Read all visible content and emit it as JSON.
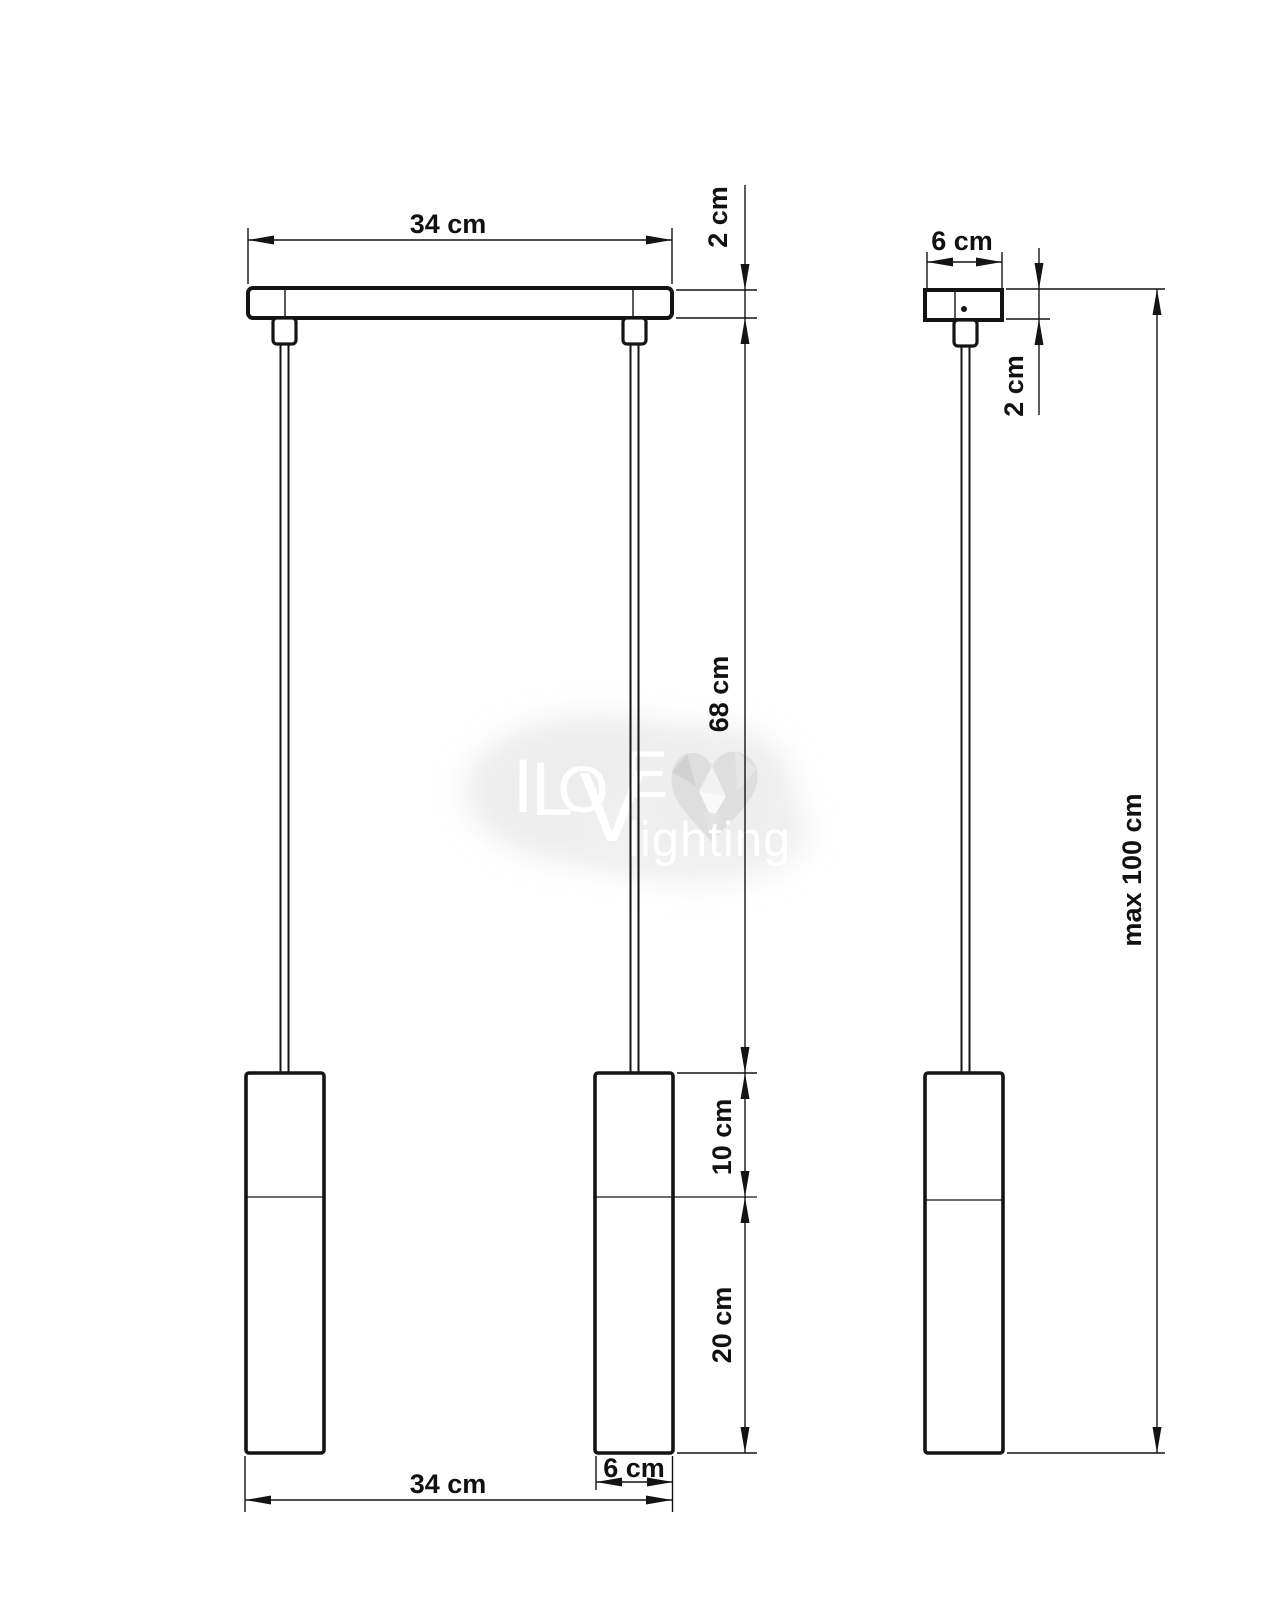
{
  "page": {
    "title": "Pendant lamp dimension drawing",
    "background_color": "#ffffff",
    "line_color": "#141414",
    "watermark_color": "#e9e9e9"
  },
  "dimensions": {
    "front": {
      "top_width": "34 cm",
      "canopy_height": "2 cm",
      "cable_length": "68 cm",
      "shade_upper": "10 cm",
      "shade_lower": "20 cm",
      "bottom_width": "34 cm",
      "shade_diameter": "6 cm"
    },
    "side": {
      "canopy_width": "6 cm",
      "canopy_height": "2 cm",
      "max_drop": "max 100 cm"
    }
  },
  "watermark": {
    "letters": {
      "i": "I",
      "l": "L",
      "o": "O",
      "v": "V",
      "e": "E"
    },
    "word": "lighting"
  }
}
